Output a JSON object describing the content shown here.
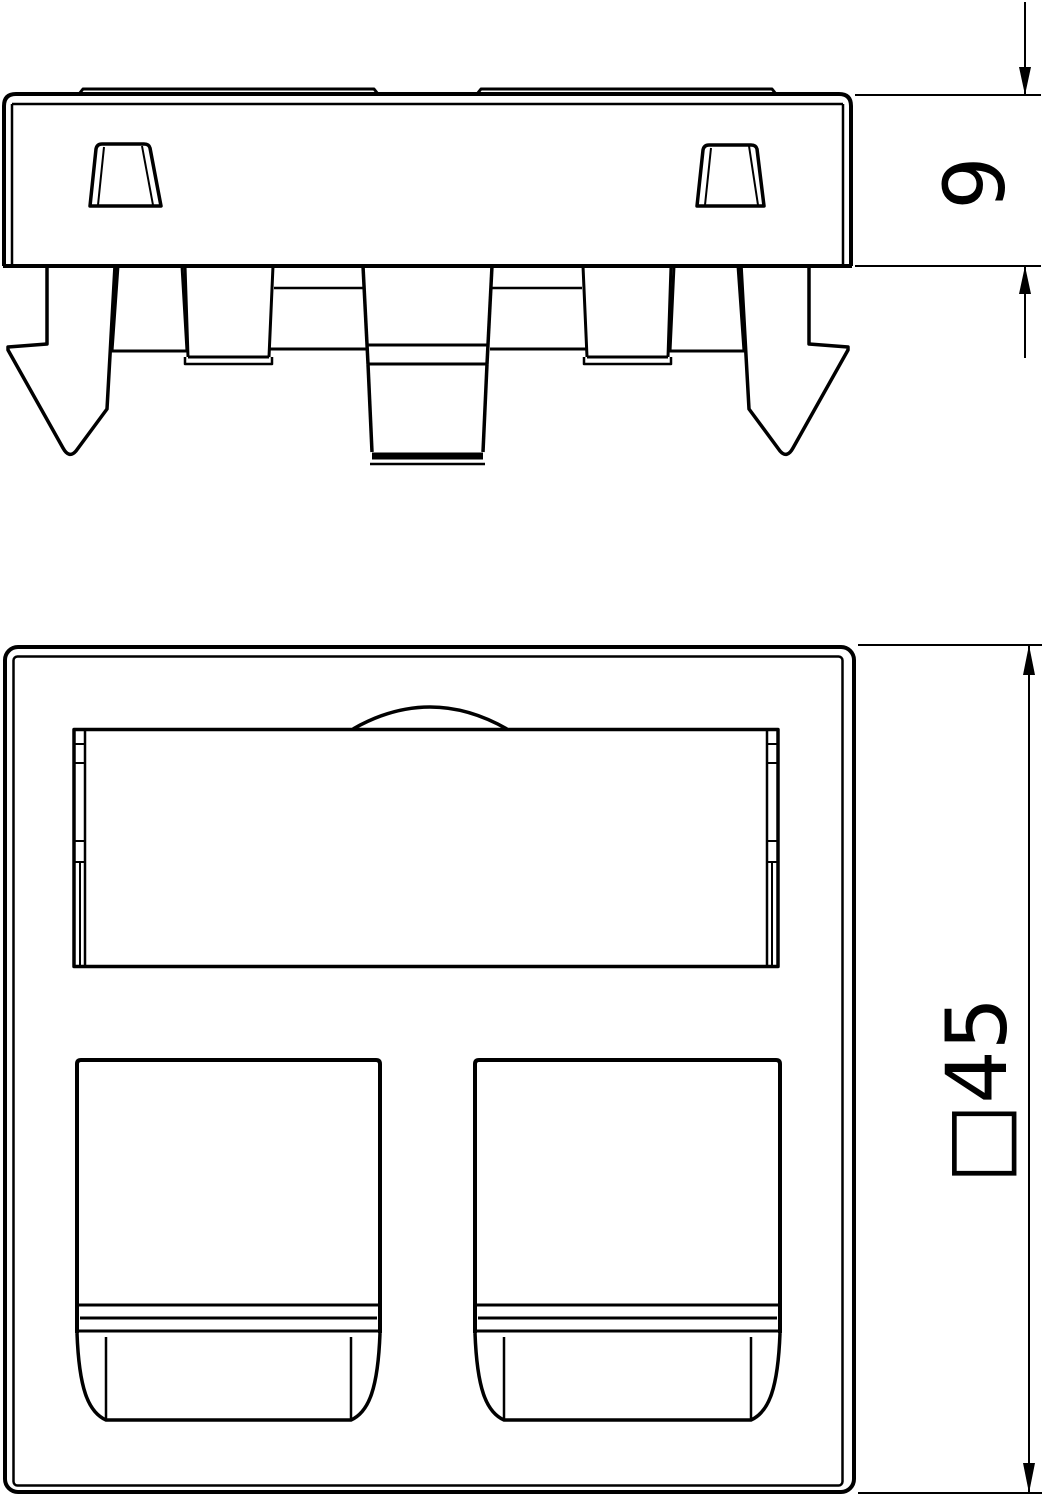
{
  "drawing": {
    "background_color": "#ffffff",
    "line_color": "#000000",
    "dimensions": {
      "side_height_label": "9",
      "front_square_label": "□45"
    }
  }
}
